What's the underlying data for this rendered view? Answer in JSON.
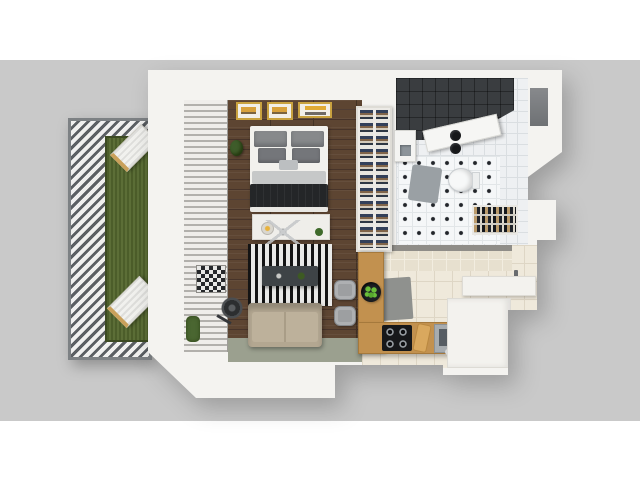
{
  "scene": {
    "title": "Studio apartment 3D floor plan, top-down render",
    "page_color": "#ffffff",
    "backdrop_color": "#c9c9c9",
    "wall_color": "#f4f3f0"
  },
  "balcony": {
    "name": "balcony terrace",
    "frame_color": "#7d8184",
    "deck_slat_light": "#f0f0ef",
    "deck_slat_dark": "#5b5f63",
    "grass_color": "#55682f",
    "lounger_color": "#f1f1ee",
    "lounger_count": 2
  },
  "living_room": {
    "name": "living and sleeping area",
    "wood_floor_color": "#5d4532",
    "entry_floor_color": "#9ba08f",
    "louver_wall_light": "#efedea",
    "louver_wall_dark": "#b2b0ac",
    "rug_black": "#141414",
    "rug_white": "#e9e9e7",
    "sofa_color": "#b3a791",
    "coffee_table_color": "#3e4346",
    "bed_frame_color": "#f2f1ed",
    "bed_throw_color": "#242628",
    "bed_duvet_color": "#c6c8c8",
    "pillow_color": "#87898b",
    "wall_art_frame_color": "#c9a23f",
    "wall_art_count": 3,
    "items": [
      "double bed",
      "three framed wall art",
      "console desk with lamp",
      "black white striped rug",
      "dark coffee table",
      "two-seat beige sofa",
      "floor fan",
      "corner plant",
      "ceiling lamp",
      "louvered window wall",
      "checker mosaic panel",
      "moss plant"
    ]
  },
  "wardrobe": {
    "name": "open wardrobe shelves",
    "frame_color": "#eceae6",
    "clothes_colors": [
      "#33405a",
      "#806449",
      "#d3cabb",
      "#2e3744"
    ]
  },
  "bathroom": {
    "name": "bathroom",
    "shower_floor_color": "#3a3d40",
    "wall_tile_color": "#eef0f2",
    "floor_tile_color": "#f5f7f8",
    "floor_dot_color": "#22252a",
    "vanity_color": "#f6f6f4",
    "sink_color": "#17181a",
    "mat_color": "#9aa0a4",
    "toilet_color": "#f7f8f8",
    "washer_color": "#f4f4f2",
    "items": [
      "dark tiled walk-in shower",
      "vanity with two black vessel sinks",
      "toilet",
      "gray bath mat",
      "washing machine",
      "wall niche"
    ]
  },
  "kitchen": {
    "name": "kitchen",
    "floor_tile_color": "#efe9db",
    "wall_tile_color": "#e7e0cf",
    "counter_wood_color": "#c2914f",
    "cooktop_color": "#17181a",
    "cooktop_burners": 4,
    "sink_steel_color": "#a7acaf",
    "cutting_board_color": "#d9a85e",
    "stool_color": "#9d9fa1",
    "stool_count": 2,
    "cabinet_color": "#f3f2ee",
    "mat_color": "#8f918e",
    "fruit_bowl_color": "#1e2125",
    "fruit_color": "#6abf3a",
    "items": [
      "wooden bar counter",
      "two bar stools",
      "fruit bowl",
      "four burner cooktop",
      "cutting board",
      "steel sink",
      "white peninsula counter",
      "white cabinet block"
    ]
  },
  "entry": {
    "name": "entry",
    "shoe_rack_color": "#1d2025",
    "door_handle_color": "#696c6f",
    "items": [
      "built-in shoe rack",
      "door handle"
    ]
  }
}
